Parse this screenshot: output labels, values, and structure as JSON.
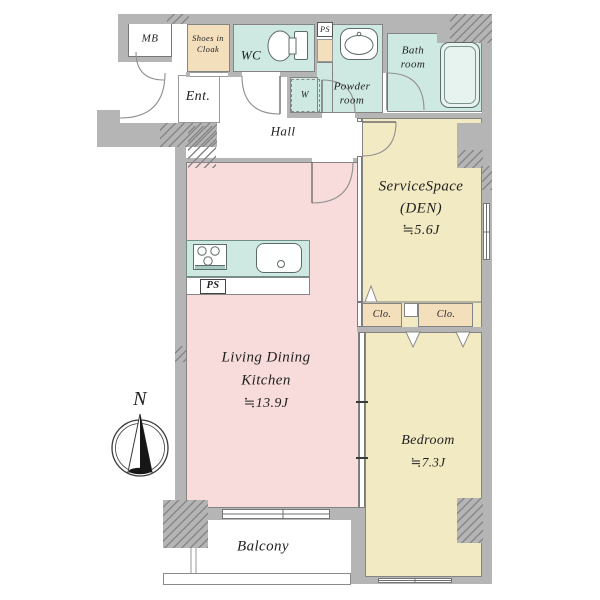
{
  "rooms": {
    "mb": {
      "label": "MB"
    },
    "shoes": {
      "line1": "Shoes in",
      "line2": "Cloak"
    },
    "wc": {
      "label": "WC"
    },
    "ps_upper": {
      "label": "PS"
    },
    "powder": {
      "line1": "Powder",
      "line2": "room"
    },
    "washer": {
      "label": "W"
    },
    "bath": {
      "line1": "Bath",
      "line2": "room"
    },
    "entrance": {
      "label": "Ent."
    },
    "hall": {
      "label": "Hall"
    },
    "service_space": {
      "line1": "ServiceSpace",
      "line2": "(DEN)",
      "area": "≒5.6J"
    },
    "closet_left": {
      "label": "Clo."
    },
    "closet_right": {
      "label": "Clo."
    },
    "ldk": {
      "line1": "Living Dining",
      "line2": "Kitchen",
      "area": "≒13.9J"
    },
    "bedroom": {
      "label": "Bedroom",
      "area": "≒7.3J"
    },
    "balcony": {
      "label": "Balcony"
    },
    "ps_kitchen": {
      "label": "PS"
    }
  },
  "compass": {
    "north": "N"
  },
  "colors": {
    "wall": "#b5b5b5",
    "ldk_pink": "#f8dcdc",
    "bedroom_beige": "#f2eac2",
    "wet_teal": "#cee8e2",
    "closet_tan": "#f3dfbc"
  }
}
